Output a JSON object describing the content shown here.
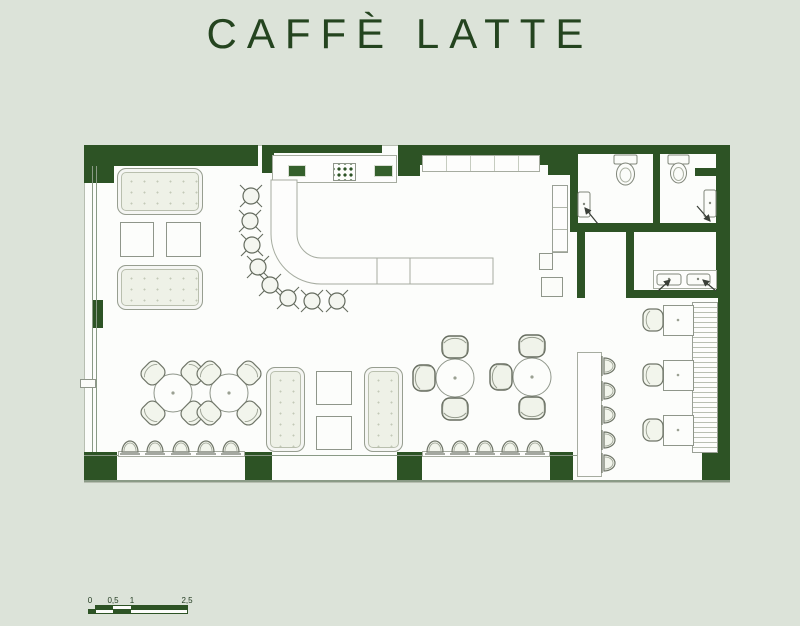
{
  "title": "CAFFÈ LATTE",
  "scale_bar": {
    "labels": [
      "0",
      "0,5",
      "1",
      "2,5"
    ]
  },
  "colors": {
    "background": "#dce3d9",
    "wall_green": "#2d5325",
    "title_green": "#24441f",
    "floor_white": "#fcfdfb"
  }
}
